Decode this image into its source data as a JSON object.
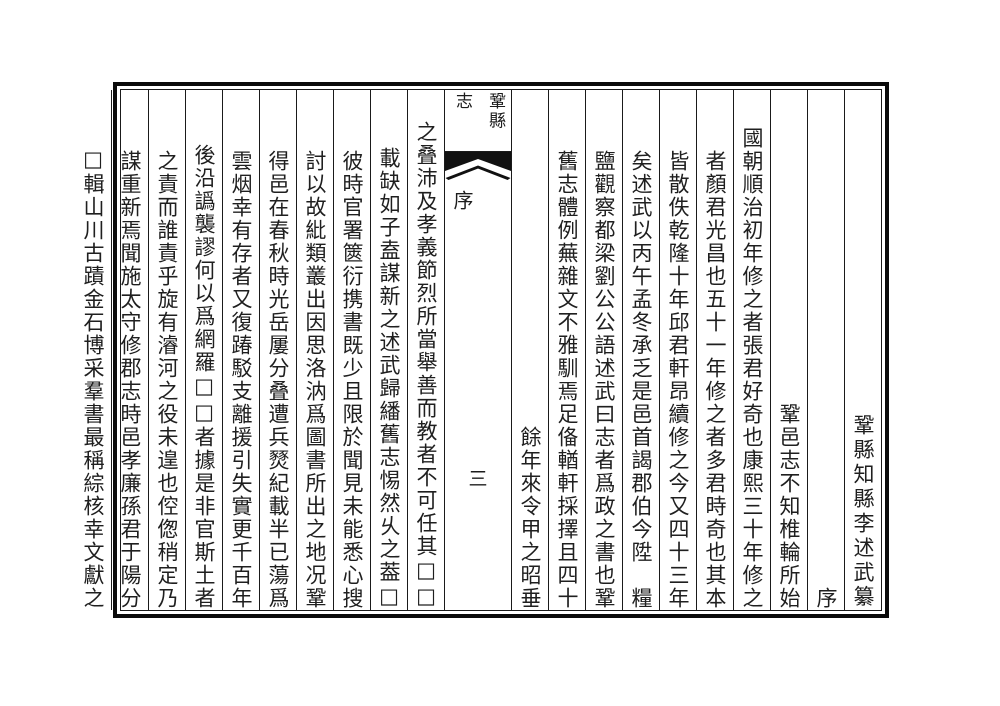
{
  "document": {
    "type": "classical-chinese-gazetteer-page",
    "reading_order": "vertical columns, right to left"
  },
  "center_column": {
    "book_title": "鞏縣志",
    "section": "序",
    "page_number": "三"
  },
  "columns": [
    {
      "text": "鞏縣知縣李述武纂",
      "align": "bottom"
    },
    {
      "text": "序",
      "align": "heading"
    },
    {
      "text": "鞏邑志不知椎輪所始",
      "align": "normal"
    },
    {
      "text": "國朝順治初年修之者張君好奇也康熙三十年修之",
      "align": "elevated"
    },
    {
      "text": "者顏君光昌也五十一年修之者多君時奇也其本",
      "align": "normal"
    },
    {
      "text": "皆散佚乾隆十年邱君軒昂續修之今又四十三年",
      "align": "normal"
    },
    {
      "text": "矣述武以丙午孟冬承乏是邑首謁郡伯今陞　糧",
      "align": "normal"
    },
    {
      "text": "鹽觀察都梁劉公公語述武曰志者爲政之書也鞏",
      "align": "normal"
    },
    {
      "text": "舊志體例蕪雜文不雅馴焉足俻輶軒採擇且四十",
      "align": "normal"
    },
    {
      "text": "餘年來令甲之昭垂",
      "align": "normal"
    },
    {
      "type": "center"
    },
    {
      "text": "□□之叠沛及孝義節烈所當舉善而教者不可任其",
      "align": "elevated"
    },
    {
      "text": "□載缺如子盍謀新之述武歸繙舊志惕然乆之葢",
      "align": "normal"
    },
    {
      "text": "彼時官署篋衍携書既少且限於聞見未能悉心搜",
      "align": "normal"
    },
    {
      "text": "討以故紕類叢出因思洛汭爲圖書所出之地况鞏",
      "align": "normal"
    },
    {
      "text": "得邑在春秋時光岳屢分叠遭兵燹紀載半已蕩爲",
      "align": "normal"
    },
    {
      "text": "雲烟幸有存者又復踳駁支離援引失實更千百年",
      "align": "normal"
    },
    {
      "text": "後沿譌襲謬何以爲網羅□□者據是非官斯土者",
      "align": "normal"
    },
    {
      "text": "之責而誰責乎旋有濬河之役未遑也倥偬稍定乃",
      "align": "normal"
    },
    {
      "text": "謀重新焉聞施太守修郡志時邑孝廉孫君于陽分",
      "align": "normal"
    },
    {
      "text": "輯山川古蹟金石博采羣書最稱綜核幸文獻之□",
      "align": "normal"
    }
  ],
  "colors": {
    "ink": "#1f1f1f",
    "frame": "#0a0a0a",
    "paper": "#ffffff"
  }
}
